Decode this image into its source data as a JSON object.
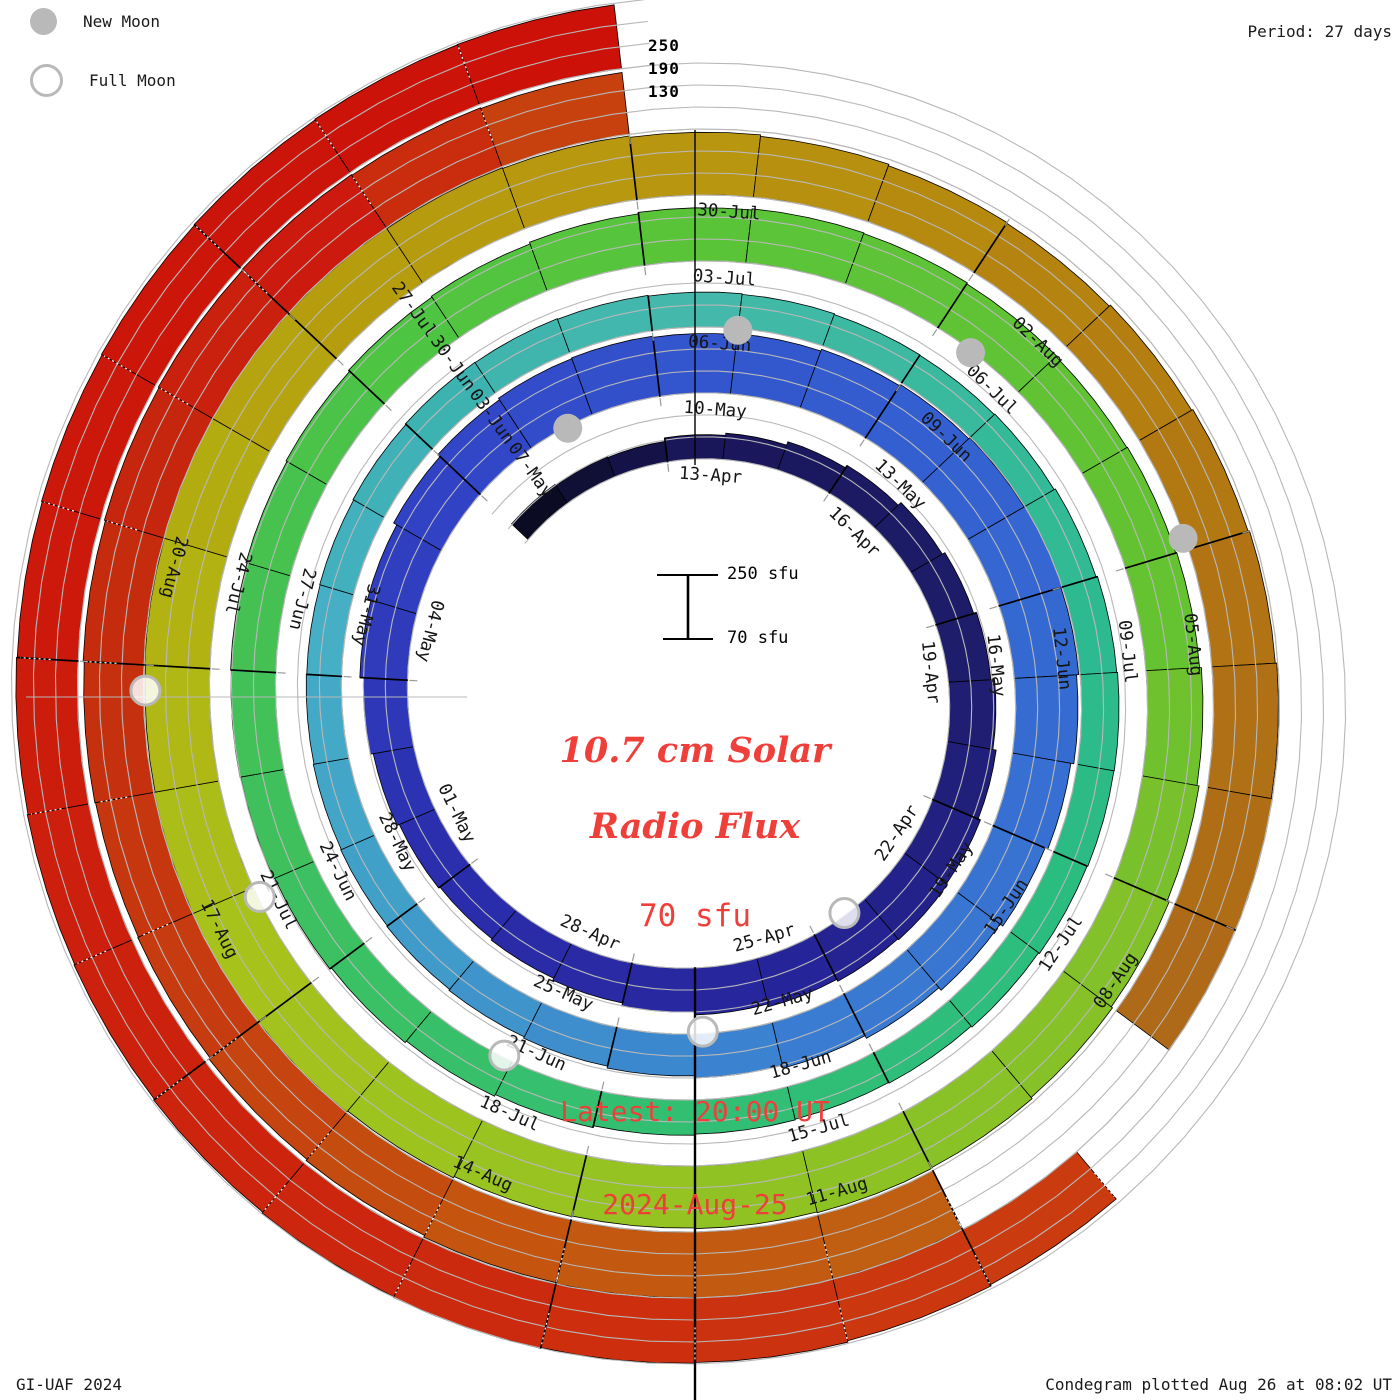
{
  "legend": {
    "new_moon_label": "New Moon",
    "full_moon_label": "Full Moon"
  },
  "period_label": "Period: 27 days",
  "footer": {
    "left": "GI-UAF 2024",
    "right": "Condegram plotted Aug 26 at 08:02 UT"
  },
  "center": {
    "title_line1": "10.7 cm Solar",
    "title_line2": "Radio Flux",
    "base_flux": "70 sfu",
    "latest_line1": "Latest: 20:00 UT",
    "latest_line2": "2024-Aug-25"
  },
  "scale_bar": {
    "top_label": "250 sfu",
    "bottom_label": "70 sfu"
  },
  "radial_scale_labels": [
    "250",
    "190",
    "130"
  ],
  "colors": {
    "accent_red": "#ef3f3a",
    "moon_gray": "#b9b9b9",
    "grid_gray": "#b8b8b8",
    "tick_gray": "#9a9a9a",
    "bar_outline": "#000000",
    "label_ink": "#151515"
  },
  "chart_data": {
    "type": "spiral-condegram",
    "title": "10.7 cm Solar Radio Flux",
    "period_days": 27,
    "flux_min": 70,
    "flux_max": 250,
    "gridline_levels": [
      70,
      130,
      190,
      250
    ],
    "start_day_offset": -3,
    "start_date": "2024-04-10",
    "top_date": "2024-04-13",
    "flux": [
      132,
      128,
      126,
      136,
      142,
      152,
      160,
      170,
      178,
      186,
      196,
      205,
      212,
      215,
      212,
      206,
      198,
      190,
      182,
      176,
      172,
      176,
      182,
      190,
      200,
      210,
      220,
      228,
      233,
      235,
      232,
      235,
      240,
      244,
      248,
      250,
      246,
      240,
      232,
      224,
      215,
      206,
      198,
      190,
      184,
      179,
      175,
      172,
      170,
      168,
      166,
      165,
      166,
      168,
      170,
      169,
      167,
      165,
      163,
      161,
      160,
      162,
      166,
      170,
      172,
      171,
      169,
      166,
      163,
      161,
      163,
      166,
      171,
      176,
      181,
      186,
      189,
      191,
      193,
      196,
      199,
      203,
      206,
      211,
      215,
      218,
      216,
      213,
      211,
      213,
      216,
      221,
      227,
      233,
      237,
      241,
      243,
      241,
      239,
      241,
      245,
      249,
      252,
      249,
      246,
      248,
      252,
      252,
      249,
      247,
      245,
      241,
      237,
      233,
      231,
      235,
      239,
      243,
      247,
      252,
      253,
      null,
      null,
      249,
      252,
      249,
      246,
      241,
      237,
      233,
      231,
      233,
      236,
      239,
      241,
      243,
      241,
      239,
      null,
      null,
      null,
      null,
      null,
      null,
      null,
      null,
      null,
      null,
      null,
      238,
      242,
      246,
      248,
      250,
      248,
      245,
      242,
      240,
      238,
      236,
      238,
      240,
      242,
      244,
      245
    ],
    "color_stops": [
      [
        -3,
        "#0b0b24"
      ],
      [
        0,
        "#191659"
      ],
      [
        6,
        "#1d1d6b"
      ],
      [
        12,
        "#262499"
      ],
      [
        18,
        "#2b2fae"
      ],
      [
        24,
        "#3247c8"
      ],
      [
        27,
        "#3355cd"
      ],
      [
        33,
        "#3569d2"
      ],
      [
        39,
        "#3a7cd2"
      ],
      [
        45,
        "#41a0c8"
      ],
      [
        48,
        "#46aec5"
      ],
      [
        51,
        "#3cb3b0"
      ],
      [
        54,
        "#44b9ab"
      ],
      [
        60,
        "#2eba90"
      ],
      [
        63,
        "#2bbc80"
      ],
      [
        69,
        "#35bf6e"
      ],
      [
        75,
        "#45c154"
      ],
      [
        78,
        "#4ec443"
      ],
      [
        81,
        "#5ac439"
      ],
      [
        87,
        "#65c231"
      ],
      [
        90,
        "#82c129"
      ],
      [
        96,
        "#98c321"
      ],
      [
        99,
        "#a8c21c"
      ],
      [
        102,
        "#b2b312"
      ],
      [
        105,
        "#b69d0e"
      ],
      [
        108,
        "#b8960f"
      ],
      [
        111,
        "#b5830f"
      ],
      [
        114,
        "#b17313"
      ],
      [
        117,
        "#ae6a18"
      ],
      [
        120,
        "#c05f12"
      ],
      [
        123,
        "#c5540f"
      ],
      [
        126,
        "#c63c10"
      ],
      [
        129,
        "#c52c0e"
      ],
      [
        132,
        "#cc1a0e"
      ],
      [
        135,
        "#c4540f"
      ],
      [
        144,
        "#c94310"
      ],
      [
        150,
        "#cc2a0e"
      ],
      [
        156,
        "#cc190c"
      ],
      [
        161,
        "#cc1208"
      ]
    ],
    "date_labels": [
      [
        0,
        "13-Apr"
      ],
      [
        3,
        "16-Apr"
      ],
      [
        6,
        "19-Apr"
      ],
      [
        9,
        "22-Apr"
      ],
      [
        12,
        "25-Apr"
      ],
      [
        15,
        "28-Apr"
      ],
      [
        18,
        "01-May"
      ],
      [
        21,
        "04-May"
      ],
      [
        24,
        "07-May"
      ],
      [
        27,
        "10-May"
      ],
      [
        30,
        "13-May"
      ],
      [
        33,
        "16-May"
      ],
      [
        36,
        "19-May"
      ],
      [
        39,
        "22-May"
      ],
      [
        42,
        "25-May"
      ],
      [
        45,
        "28-May"
      ],
      [
        48,
        "31-May"
      ],
      [
        51,
        "03-Jun"
      ],
      [
        54,
        "06-Jun"
      ],
      [
        57,
        "09-Jun"
      ],
      [
        60,
        "12-Jun"
      ],
      [
        63,
        "15-Jun"
      ],
      [
        66,
        "18-Jun"
      ],
      [
        69,
        "21-Jun"
      ],
      [
        72,
        "24-Jun"
      ],
      [
        75,
        "27-Jun"
      ],
      [
        78,
        "30-Jun"
      ],
      [
        81,
        "03-Jul"
      ],
      [
        84,
        "06-Jul"
      ],
      [
        87,
        "09-Jul"
      ],
      [
        90,
        "12-Jul"
      ],
      [
        93,
        "15-Jul"
      ],
      [
        96,
        "18-Jul"
      ],
      [
        99,
        "21-Jul"
      ],
      [
        102,
        "24-Jul"
      ],
      [
        105,
        "27-Jul"
      ],
      [
        108,
        "30-Jul"
      ],
      [
        111,
        "02-Aug"
      ],
      [
        114,
        "05-Aug"
      ],
      [
        117,
        "08-Aug"
      ],
      [
        120,
        "11-Aug"
      ],
      [
        123,
        "14-Aug"
      ],
      [
        126,
        "17-Aug"
      ],
      [
        129,
        "20-Aug"
      ]
    ],
    "new_moons_day": [
      25.1,
      54.5,
      83.9,
      113.4
    ],
    "full_moons_day": [
      10.9,
      40.4,
      69.6,
      99.4,
      128.3
    ],
    "forecast_dash_from_day": 120
  }
}
